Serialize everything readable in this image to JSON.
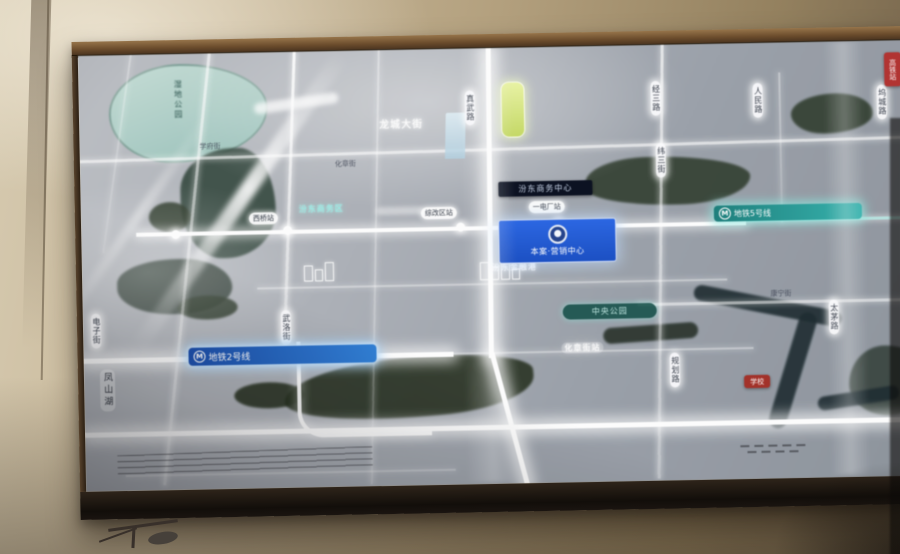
{
  "map": {
    "project_badge": {
      "label": "本案·营销中心"
    },
    "cbd_badge": {
      "label": "汾东商务中心"
    },
    "metro": {
      "logo": "M",
      "line2": "地铁2号线",
      "line5": "地铁5号线"
    },
    "park_pill": {
      "label": "中央公园"
    },
    "lakes": {
      "top_label": "湿地公园",
      "left_label": "凤山湖"
    },
    "glow_labels": {
      "top": "龙城大街",
      "cbd": "汾东商务区",
      "finance": "汾东金融港",
      "station": "化章街站"
    },
    "road_badges": [
      "真武路",
      "经三路",
      "人民路",
      "坞城路",
      "纬三街",
      "规划路",
      "太茅路",
      "武洛街",
      "电子街"
    ],
    "stations": [
      "西桥站",
      "综改区站",
      "一电厂站"
    ],
    "street_labels": [
      "学府街",
      "化章街",
      "康宁街"
    ],
    "red_badges": [
      "高铁站",
      "学校"
    ]
  },
  "colors": {
    "metro_line2": "#2f7fd6",
    "metro_line5": "#35b3ae",
    "project_blue": "#1a4fc4",
    "red_badge": "#b23230",
    "road_glow": "#ffffff"
  }
}
